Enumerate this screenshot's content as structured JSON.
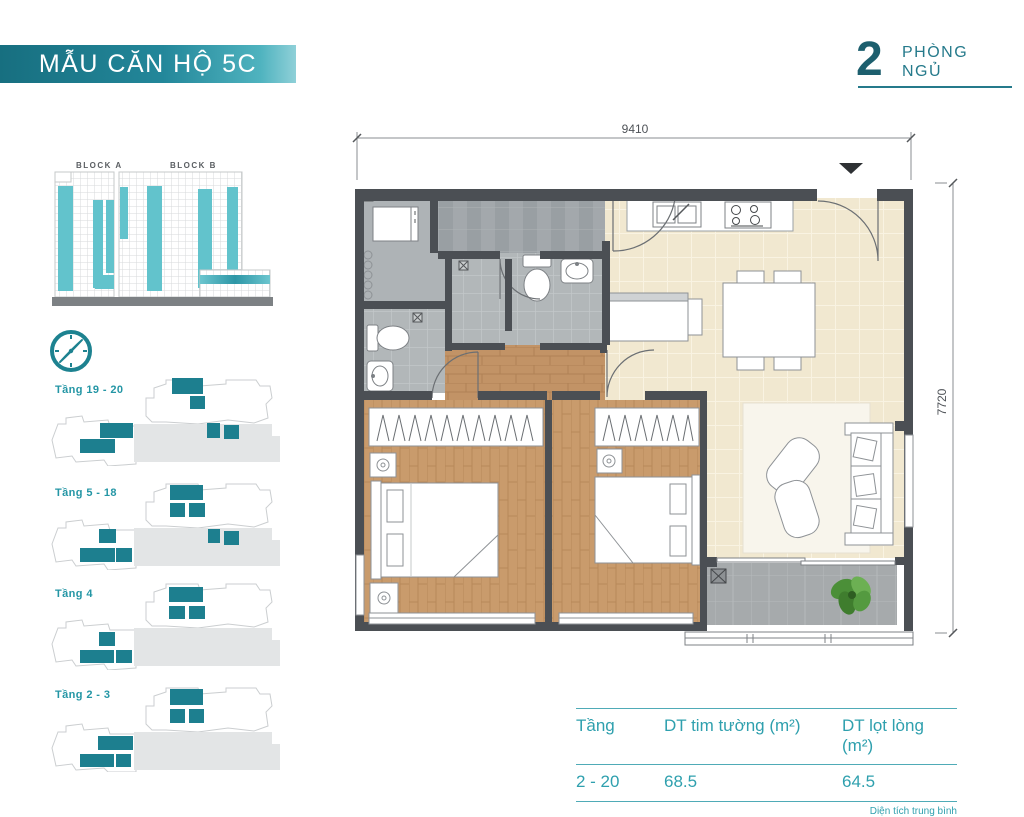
{
  "header": {
    "title": "MẪU CĂN HỘ 5C"
  },
  "unit": {
    "count": "2",
    "label_line1": "PHÒNG",
    "label_line2": "NGỦ"
  },
  "elevation": {
    "block_a": "BLOCK A",
    "block_b": "BLOCK B"
  },
  "floors": [
    {
      "label": "Tầng 19 - 20"
    },
    {
      "label": "Tầng 5 - 18"
    },
    {
      "label": "Tầng 4"
    },
    {
      "label": "Tầng 2 - 3"
    }
  ],
  "plan": {
    "dim_width": "9410",
    "dim_height": "7720"
  },
  "table": {
    "headers": [
      "Tầng",
      "DT tim tường (m²)",
      "DT lọt lòng (m²)"
    ],
    "row": [
      "2 - 20",
      "68.5",
      "64.5"
    ],
    "note": "Diện tích trung bình"
  },
  "colors": {
    "teal_dark": "#1d7f8f",
    "teal_text": "#2496a5",
    "teal_light": "#62c3cc",
    "wall": "#4b4f54",
    "wood": "#c99b6c",
    "beige": "#f1e8d0",
    "gray_tile": "#b2b7b9"
  }
}
